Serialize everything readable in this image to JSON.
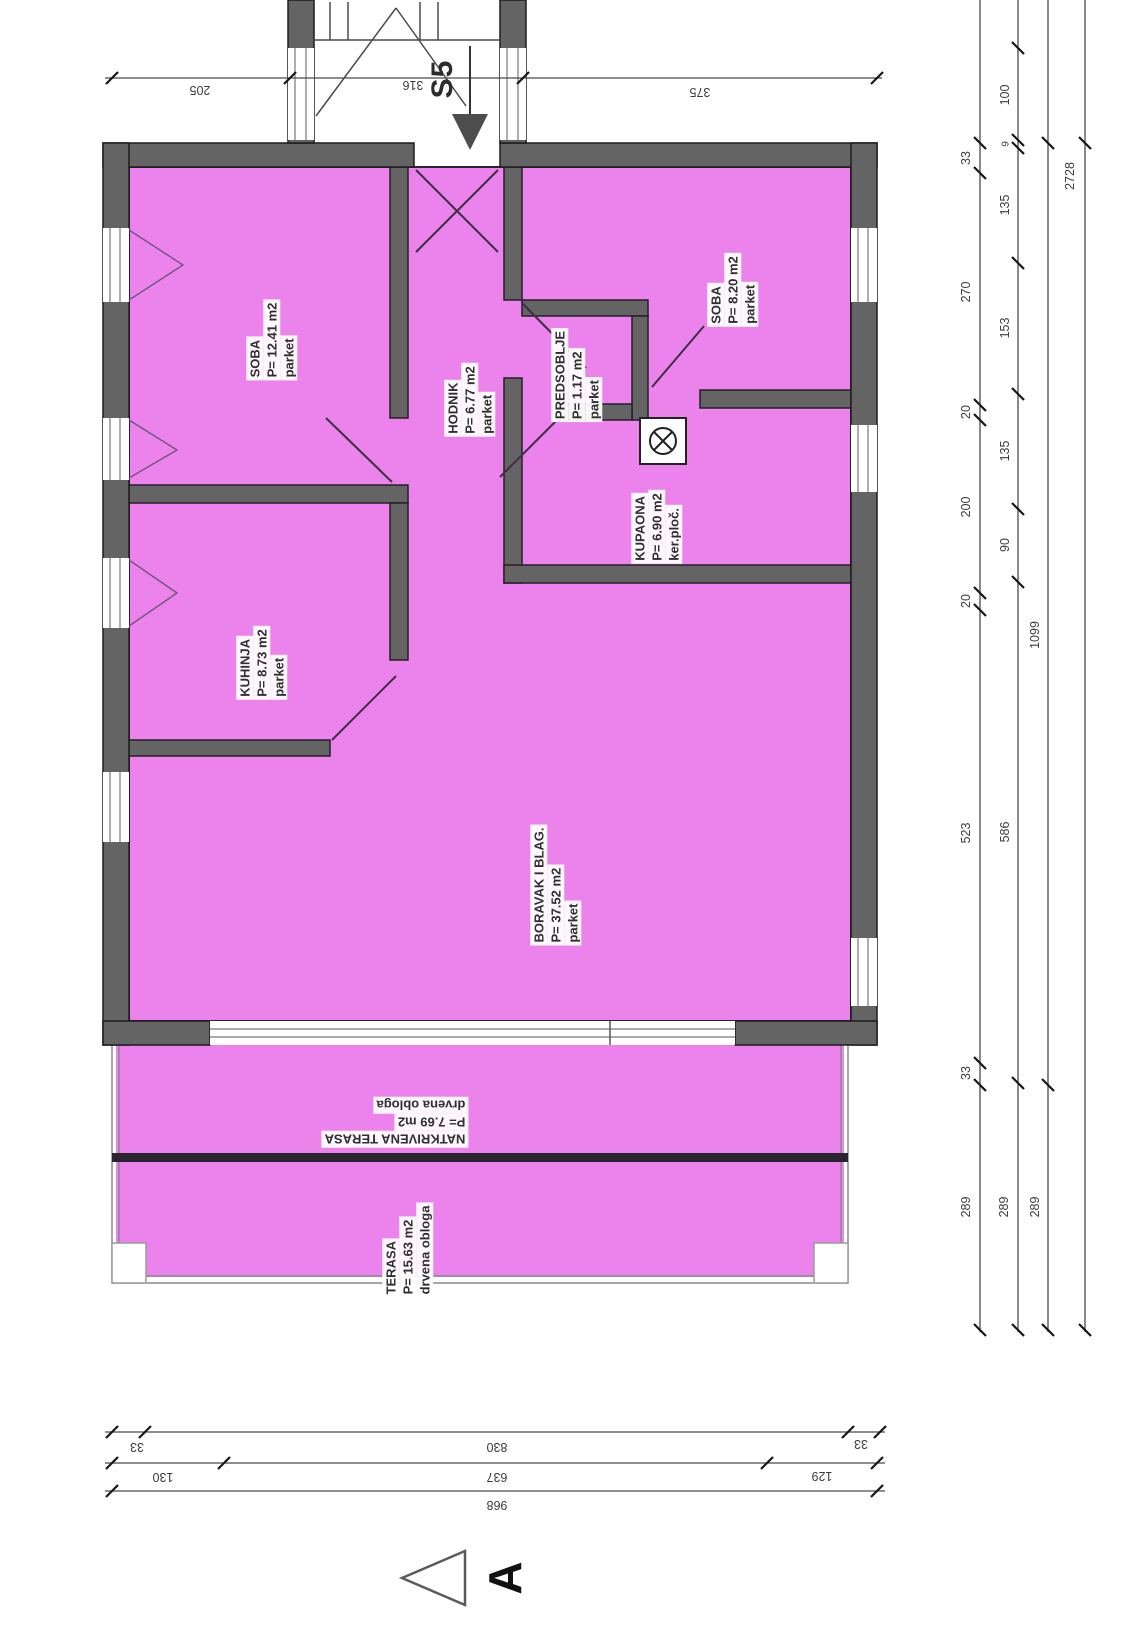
{
  "title": "Apartment S5 floor plan",
  "rooms": {
    "soba1": {
      "name": "SOBA",
      "area": "P= 12.41 m2",
      "floor": "parket"
    },
    "hodnik": {
      "name": "HODNIK",
      "area": "P= 6.77 m2",
      "floor": "parket"
    },
    "predsoblje": {
      "name": "PREDSOBLJE",
      "area": "P= 1.17 m2",
      "floor": "parket"
    },
    "soba2": {
      "name": "SOBA",
      "area": "P= 8.20 m2",
      "floor": "parket"
    },
    "kupaona": {
      "name": "KUPAONA",
      "area": "P= 6.90 m2",
      "floor": "ker.ploč."
    },
    "kuhinja": {
      "name": "KUHINJA",
      "area": "P= 8.73 m2",
      "floor": "parket"
    },
    "boravak": {
      "name": "BORAVAK I BLAG.",
      "area": "P= 37.52 m2",
      "floor": "parket"
    },
    "natkrivena": {
      "name": "NATKRIVENA TERASA",
      "area": "P= 7.69 m2",
      "floor": "drvena obloga"
    },
    "terasa": {
      "name": "TERASA",
      "area": "P= 15.63 m2",
      "floor": "drvena obloga"
    }
  },
  "markers": {
    "stair_section": "S5",
    "section": "A"
  },
  "dims": {
    "top": [
      "205",
      "316",
      "375"
    ],
    "right1": [
      "33",
      "270",
      "20",
      "200",
      "20",
      "523",
      "33",
      "289"
    ],
    "right2": [
      "100",
      "9",
      "135",
      "153",
      "135",
      "90",
      "586",
      "289"
    ],
    "right3": [
      "1099",
      "289"
    ],
    "right4": [
      "2728"
    ],
    "bottom1": [
      "33",
      "830",
      "33"
    ],
    "bottom2": [
      "130",
      "637",
      "129"
    ],
    "bottom3": [
      "968"
    ]
  },
  "colors": {
    "room_fill": "#ec82ec",
    "wall": "#646464",
    "wall_outline": "#1d1d1d",
    "partition_outline": "#241f26",
    "dim_line": "#4a4a4a",
    "terrace_divider": "#2a2430"
  }
}
